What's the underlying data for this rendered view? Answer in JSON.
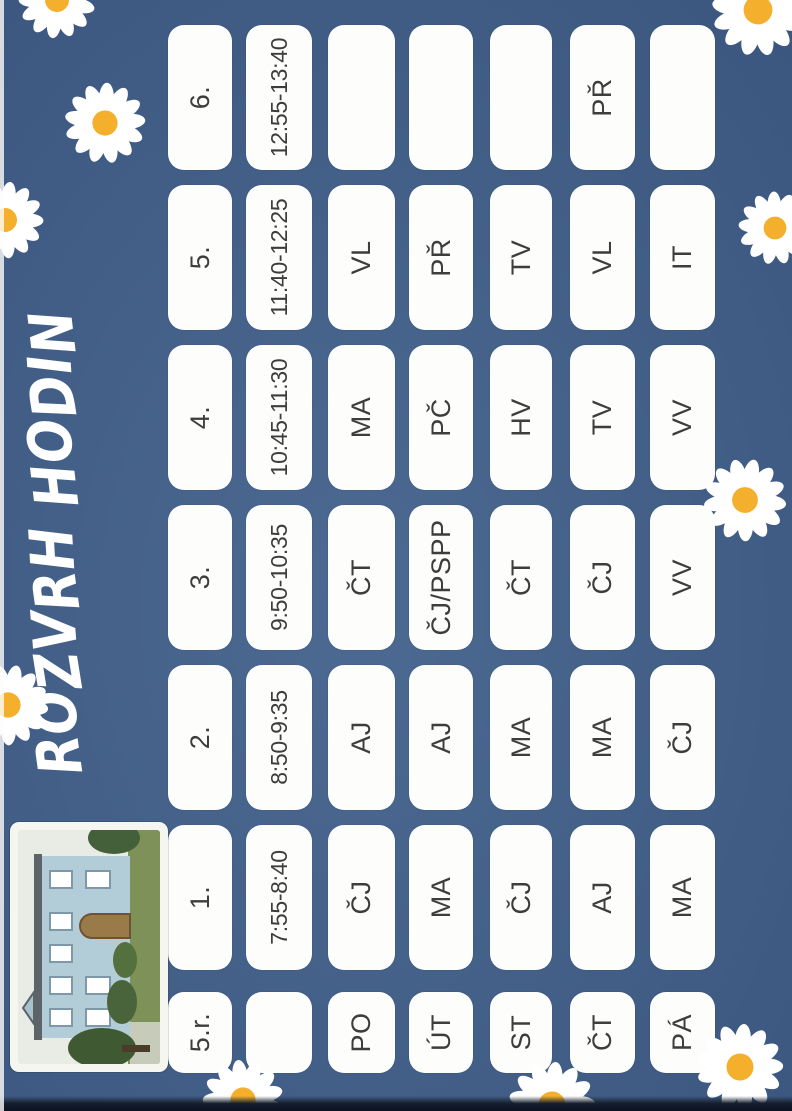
{
  "title": "ROZVRH HODIN",
  "class_label": "5.r.",
  "table": {
    "periods": [
      "1.",
      "2.",
      "3.",
      "4.",
      "5.",
      "6."
    ],
    "times": [
      "7:55-8:40",
      "8:50-9:35",
      "9:50-10:35",
      "10:45-11:30",
      "11:40-12:25",
      "12:55-13:40"
    ],
    "days": [
      {
        "name": "PO",
        "subjects": [
          "ČJ",
          "AJ",
          "ČT",
          "MA",
          "VL",
          ""
        ]
      },
      {
        "name": "ÚT",
        "subjects": [
          "MA",
          "AJ",
          "ČJ/PSPP",
          "PČ",
          "PŘ",
          ""
        ]
      },
      {
        "name": "ST",
        "subjects": [
          "ČJ",
          "MA",
          "ČT",
          "HV",
          "TV",
          ""
        ]
      },
      {
        "name": "ČT",
        "subjects": [
          "AJ",
          "MA",
          "ČJ",
          "TV",
          "VL",
          "PŘ"
        ]
      },
      {
        "name": "PÁ",
        "subjects": [
          "MA",
          "ČJ",
          "VV",
          "VV",
          "IT",
          ""
        ]
      }
    ]
  },
  "decor": {
    "flower_icon": "daisy-icon",
    "photo": "school-building-photo"
  },
  "colors": {
    "background": "#41608c",
    "cell": "#fdfdfb",
    "cell_text": "#3d3d3d",
    "title": "#ffffff",
    "daisy_petal": "#ffffff",
    "daisy_center": "#f4b02c",
    "scan_edge": "#0b1220"
  }
}
